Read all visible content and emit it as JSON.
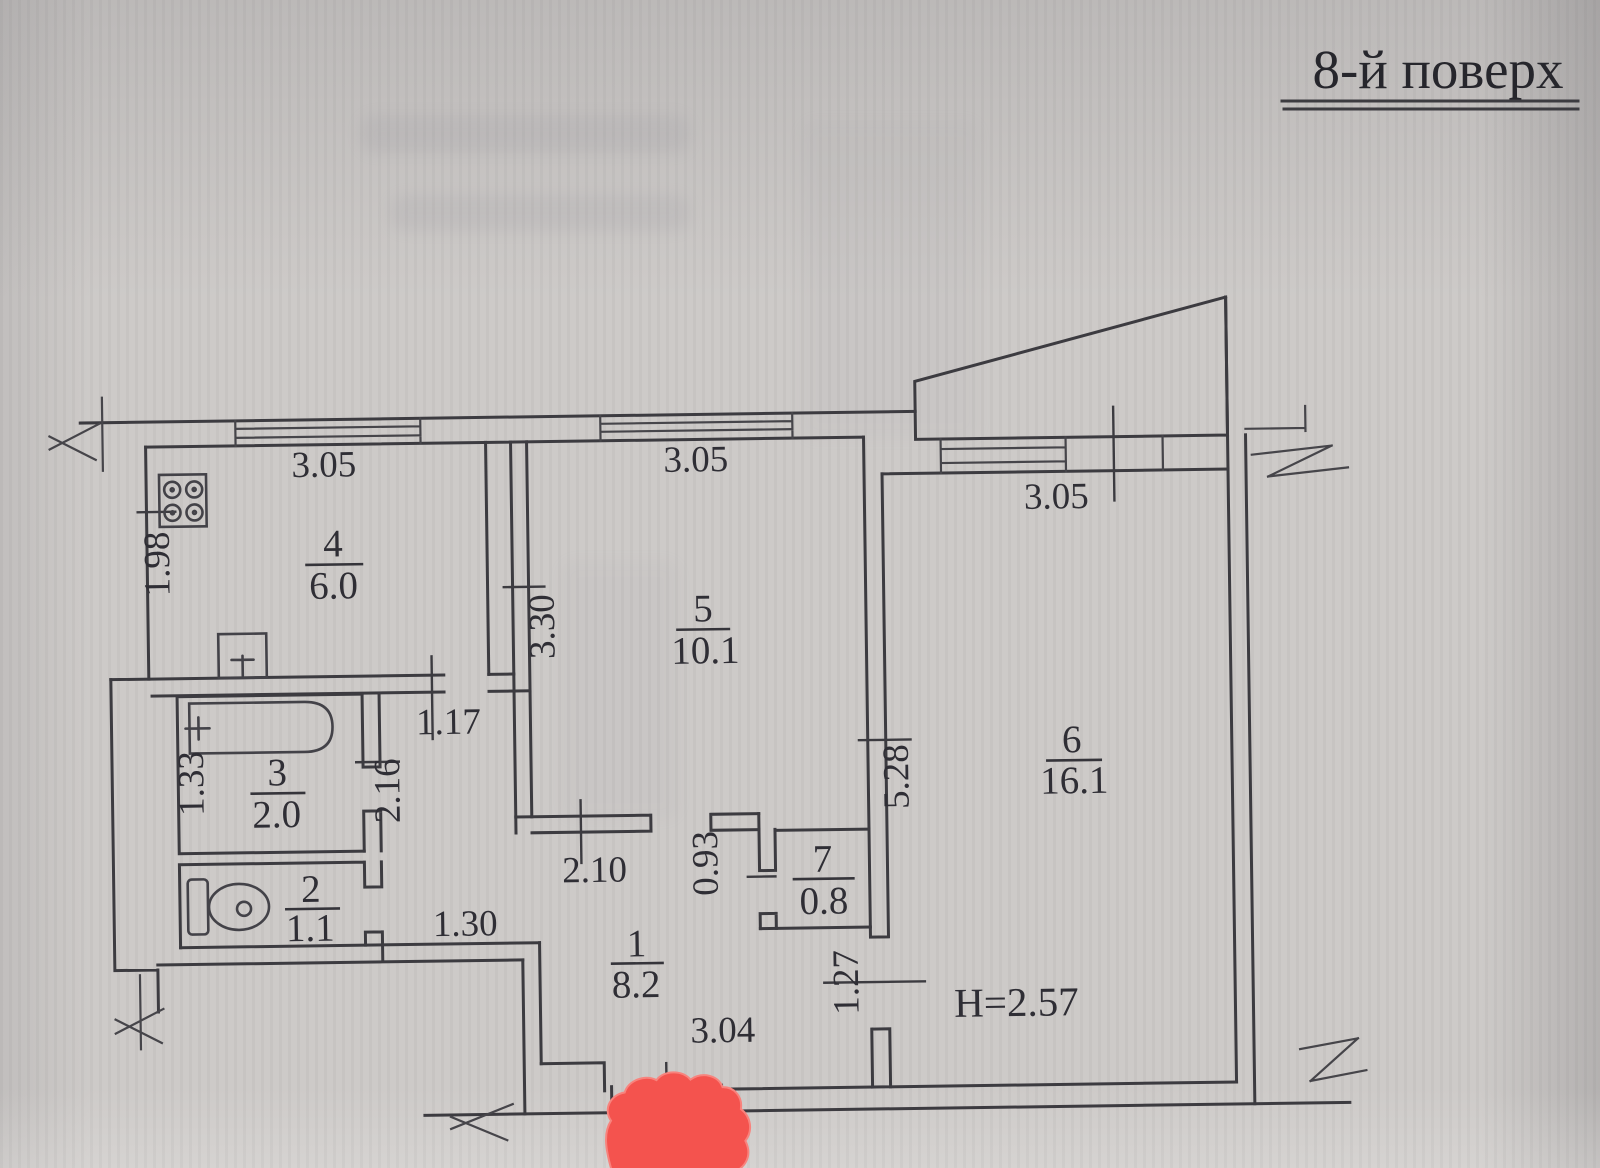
{
  "title": "8-й поверх",
  "plan": {
    "rooms": {
      "r1": {
        "num": "1",
        "area": "8.2"
      },
      "r2": {
        "num": "2",
        "area": "1.1"
      },
      "r3": {
        "num": "3",
        "area": "2.0"
      },
      "r4": {
        "num": "4",
        "area": "6.0"
      },
      "r5": {
        "num": "5",
        "area": "10.1"
      },
      "r6": {
        "num": "6",
        "area": "16.1"
      },
      "r7": {
        "num": "7",
        "area": "0.8"
      }
    },
    "dimensions": {
      "kitchen_width": "3.05",
      "kitchen_depth": "1.98",
      "room5_width": "3.05",
      "room5_depth": "3.30",
      "room6_width": "3.05",
      "room6_depth": "5.28",
      "bath_depth": "1.33",
      "hall_passage": "1.17",
      "hall_depth": "2.16",
      "wc_passage": "1.30",
      "room5_bottom": "2.10",
      "niche_depth": "0.93",
      "hall_width": "3.04",
      "room6_door": "1.27",
      "ceiling_height": "H=2.57"
    }
  }
}
